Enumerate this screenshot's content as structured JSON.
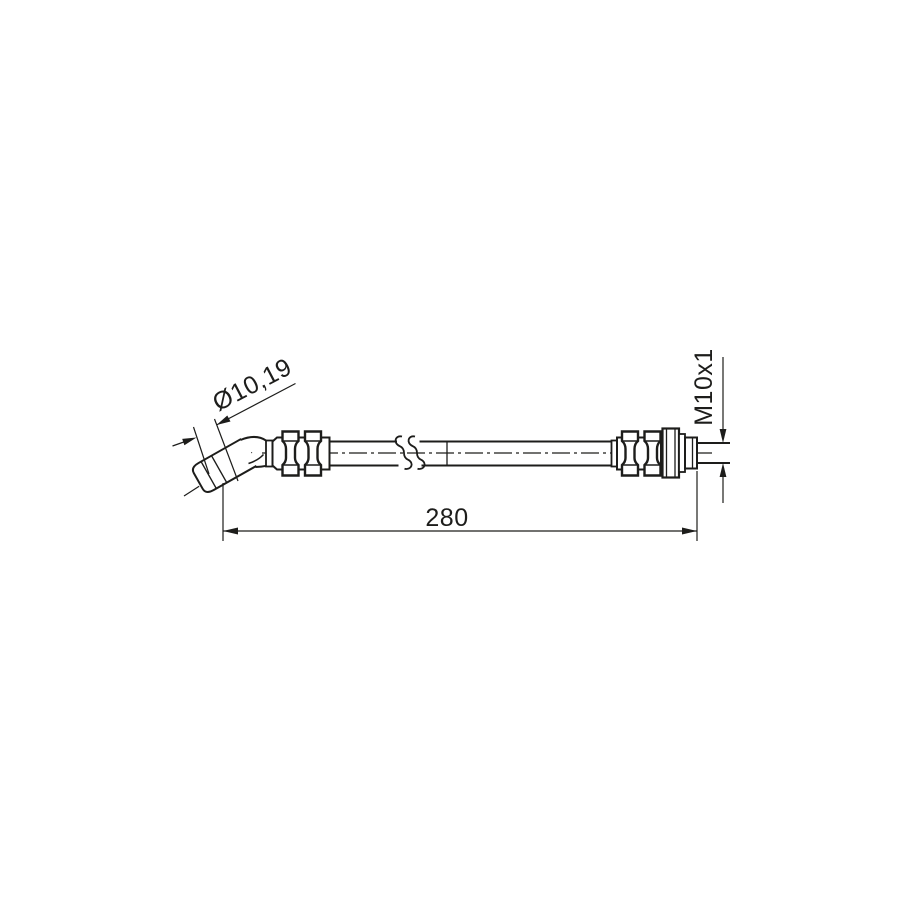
{
  "page": {
    "background_color": "#ffffff",
    "ink_color": "#1d1d1b"
  },
  "drawing": {
    "subject": "brake-hose-side-view",
    "labels": {
      "diameter": "Ø10,19",
      "thread": "M10x1",
      "length": "280"
    }
  }
}
